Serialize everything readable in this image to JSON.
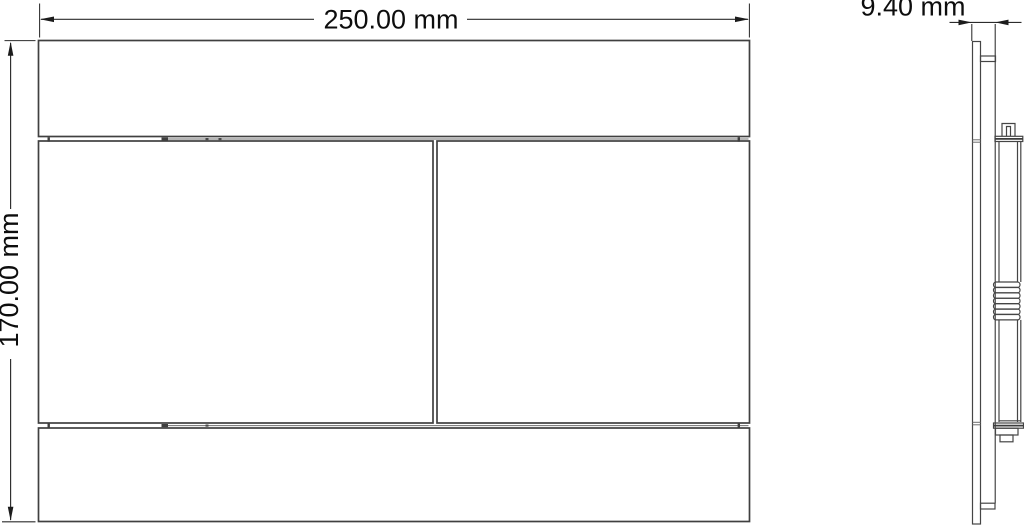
{
  "drawing": {
    "labels": {
      "width": "250.00 mm",
      "height": "170.00 mm",
      "depth": "9.40 mm"
    },
    "colors": {
      "background": "#ffffff",
      "outline": "#404040",
      "dimension_line": "#2c2c2c",
      "text": "#0d0d0d"
    }
  }
}
